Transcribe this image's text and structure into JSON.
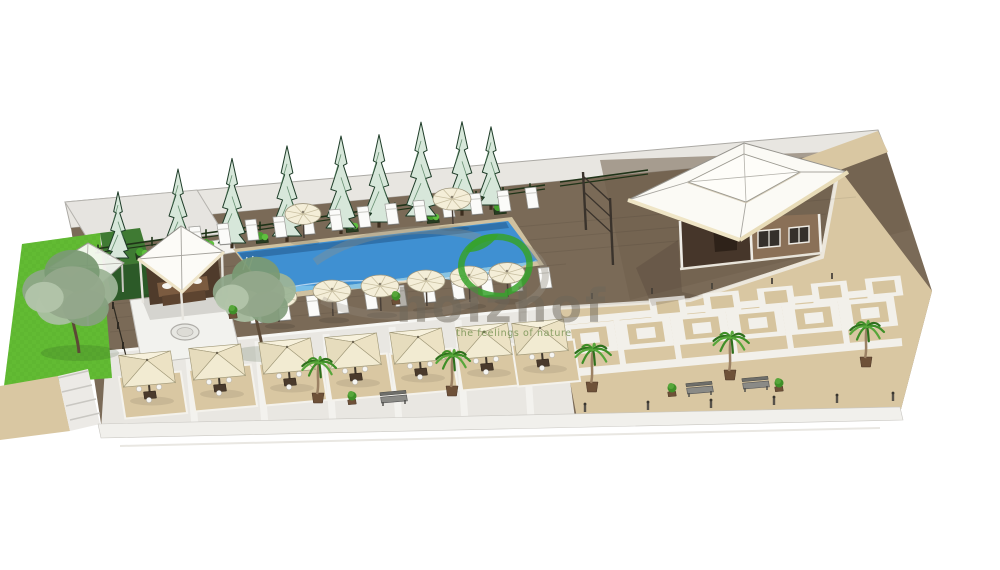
{
  "watermark": {
    "brand": "holzhof",
    "tagline": "the feelings of nature",
    "brand_color": "rgba(108,102,90,0.5)",
    "tagline_color": "rgba(118,146,82,0.85)",
    "leaf_green": "#36a22b"
  },
  "palette": {
    "background": "#ffffff",
    "deck_brown": "#7a6a57",
    "plaza_beige": "#d9c7a2",
    "light_paving": "#e9e7e2",
    "back_strip": "#e8e6e1",
    "lawn_green": "#62bb33",
    "hedge_green": "#2c5a28",
    "pool_blue": "#3f90d2",
    "pool_light": "#7fc4ea",
    "umbrella_cream": "#f4eed8",
    "roof_white": "#fbfaf5",
    "fascia_cream": "#efe5c6",
    "wall_brown": "#8a7057",
    "pine_fill": "#d7e7da",
    "pine_edge": "#1e3c28"
  },
  "scene": {
    "axes": {
      "u": [
        0.996,
        -0.088
      ],
      "v": [
        0.152,
        0.988
      ]
    },
    "pines": [
      {
        "x": 118,
        "y": 258,
        "s": 0.72
      },
      {
        "x": 178,
        "y": 250,
        "s": 0.88
      },
      {
        "x": 232,
        "y": 243,
        "s": 0.92
      },
      {
        "x": 287,
        "y": 236,
        "s": 0.98
      },
      {
        "x": 341,
        "y": 228,
        "s": 1.0
      },
      {
        "x": 379,
        "y": 222,
        "s": 0.95
      },
      {
        "x": 421,
        "y": 216,
        "s": 1.02
      },
      {
        "x": 462,
        "y": 210,
        "s": 0.96
      },
      {
        "x": 491,
        "y": 205,
        "s": 0.85
      }
    ],
    "planters": [
      {
        "x": 142,
        "y": 256
      },
      {
        "x": 208,
        "y": 247
      },
      {
        "x": 262,
        "y": 240
      },
      {
        "x": 352,
        "y": 229
      },
      {
        "x": 433,
        "y": 220
      },
      {
        "x": 500,
        "y": 211
      }
    ],
    "trees": [
      {
        "x": 72,
        "y": 295,
        "r": 46
      },
      {
        "x": 256,
        "y": 296,
        "r": 40
      }
    ],
    "palms": [
      {
        "x": 318,
        "y": 403,
        "s": 1.0
      },
      {
        "x": 452,
        "y": 396,
        "s": 1.0
      },
      {
        "x": 592,
        "y": 392,
        "s": 1.05
      },
      {
        "x": 730,
        "y": 380,
        "s": 1.05
      },
      {
        "x": 866,
        "y": 367,
        "s": 1.0
      }
    ],
    "round_umbrellas": [
      {
        "x": 303,
        "y": 214,
        "r": 18
      },
      {
        "x": 452,
        "y": 199,
        "r": 19
      },
      {
        "x": 278,
        "y": 297,
        "r": 19
      },
      {
        "x": 332,
        "y": 291,
        "r": 19
      },
      {
        "x": 380,
        "y": 286,
        "r": 19
      },
      {
        "x": 426,
        "y": 281,
        "r": 19
      },
      {
        "x": 469,
        "y": 277,
        "r": 19
      },
      {
        "x": 507,
        "y": 273,
        "r": 18
      }
    ],
    "square_umbrellas": [
      {
        "x": 147,
        "y": 369
      },
      {
        "x": 217,
        "y": 362
      },
      {
        "x": 287,
        "y": 356
      },
      {
        "x": 353,
        "y": 351
      },
      {
        "x": 418,
        "y": 346
      },
      {
        "x": 484,
        "y": 341
      },
      {
        "x": 540,
        "y": 337
      }
    ],
    "mats": [
      {
        "x": 153,
        "y": 395
      },
      {
        "x": 223,
        "y": 388
      },
      {
        "x": 293,
        "y": 382
      },
      {
        "x": 359,
        "y": 377
      },
      {
        "x": 424,
        "y": 372
      },
      {
        "x": 490,
        "y": 367
      },
      {
        "x": 546,
        "y": 363
      }
    ],
    "loungers_top": [
      {
        "x": 196,
        "y": 237
      },
      {
        "x": 224,
        "y": 234
      },
      {
        "x": 252,
        "y": 230
      },
      {
        "x": 280,
        "y": 227
      },
      {
        "x": 308,
        "y": 224
      },
      {
        "x": 336,
        "y": 220
      },
      {
        "x": 364,
        "y": 217
      },
      {
        "x": 392,
        "y": 214
      },
      {
        "x": 420,
        "y": 211
      },
      {
        "x": 448,
        "y": 207
      },
      {
        "x": 476,
        "y": 204
      },
      {
        "x": 504,
        "y": 201
      },
      {
        "x": 532,
        "y": 198
      }
    ],
    "loungers_bottom": [
      {
        "x": 255,
        "y": 313
      },
      {
        "x": 284,
        "y": 310
      },
      {
        "x": 313,
        "y": 306
      },
      {
        "x": 342,
        "y": 303
      },
      {
        "x": 371,
        "y": 299
      },
      {
        "x": 400,
        "y": 296
      },
      {
        "x": 429,
        "y": 292
      },
      {
        "x": 458,
        "y": 289
      },
      {
        "x": 487,
        "y": 285
      },
      {
        "x": 516,
        "y": 281
      },
      {
        "x": 545,
        "y": 278
      }
    ],
    "plaza_tiles_plain": [
      {
        "x": 668,
        "y": 307,
        "a": 18,
        "b": 10
      },
      {
        "x": 722,
        "y": 302,
        "a": 18,
        "b": 10
      },
      {
        "x": 776,
        "y": 297,
        "a": 18,
        "b": 10
      },
      {
        "x": 830,
        "y": 292,
        "a": 18,
        "b": 10
      },
      {
        "x": 884,
        "y": 287,
        "a": 18,
        "b": 10
      }
    ],
    "plaza_tiles_nested": [
      {
        "x": 590,
        "y": 338,
        "a": 26,
        "b": 15
      },
      {
        "x": 646,
        "y": 333,
        "a": 26,
        "b": 15
      },
      {
        "x": 702,
        "y": 328,
        "a": 26,
        "b": 15
      },
      {
        "x": 758,
        "y": 323,
        "a": 26,
        "b": 15
      },
      {
        "x": 814,
        "y": 318,
        "a": 26,
        "b": 15
      },
      {
        "x": 870,
        "y": 313,
        "a": 26,
        "b": 15
      }
    ],
    "benches": [
      {
        "x": 394,
        "y": 399
      },
      {
        "x": 700,
        "y": 390
      },
      {
        "x": 756,
        "y": 385
      }
    ],
    "shrubs": [
      {
        "x": 233,
        "y": 316
      },
      {
        "x": 396,
        "y": 302
      },
      {
        "x": 672,
        "y": 394
      },
      {
        "x": 779,
        "y": 389
      },
      {
        "x": 352,
        "y": 402
      }
    ],
    "bollards": [
      {
        "x": 585,
        "y": 412
      },
      {
        "x": 648,
        "y": 410
      },
      {
        "x": 711,
        "y": 408
      },
      {
        "x": 774,
        "y": 405
      },
      {
        "x": 837,
        "y": 403
      },
      {
        "x": 893,
        "y": 401
      }
    ],
    "walk_posts": [
      {
        "x": 592,
        "y": 299
      },
      {
        "x": 652,
        "y": 294
      },
      {
        "x": 712,
        "y": 289
      },
      {
        "x": 772,
        "y": 284
      },
      {
        "x": 832,
        "y": 279
      }
    ]
  }
}
